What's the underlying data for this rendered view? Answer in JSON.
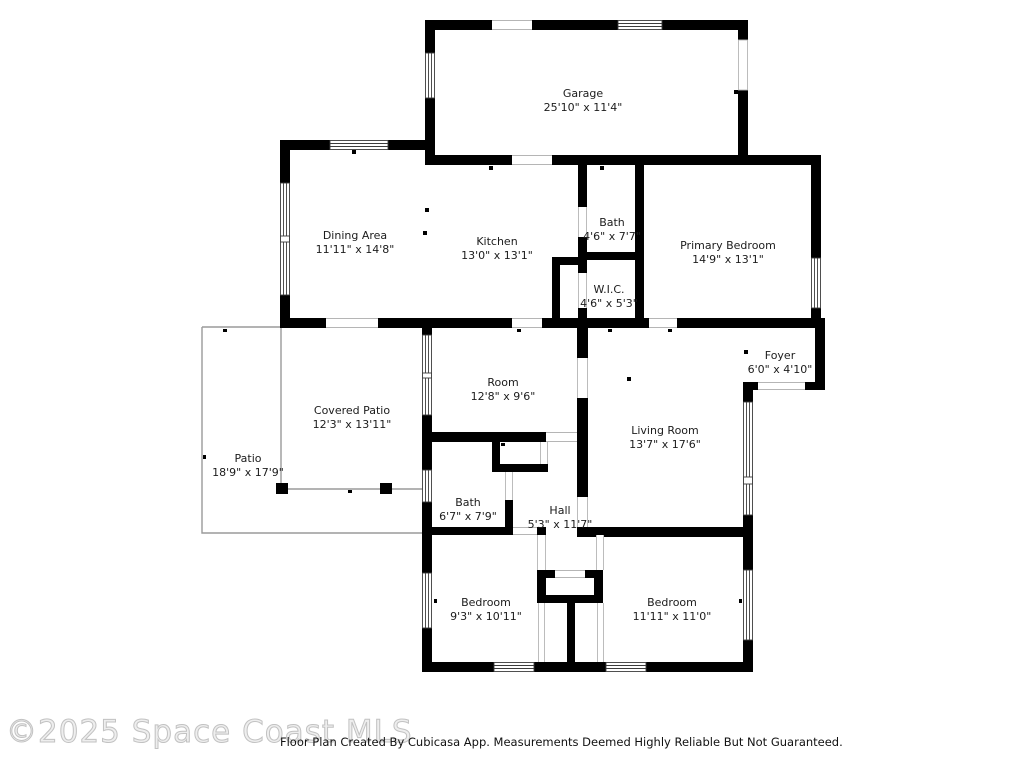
{
  "page": {
    "watermark": "©2025 Space Coast MLS",
    "footer": "Floor Plan Created By Cubicasa App. Measurements Deemed Highly Reliable But Not Guaranteed."
  },
  "floor_plan": {
    "wall_color": "#000000",
    "patio_line_color": "#9a9a9a",
    "rooms": [
      {
        "id": "garage",
        "name": "Garage",
        "dimensions": "25'10\" x 11'4\""
      },
      {
        "id": "dining-area",
        "name": "Dining Area",
        "dimensions": "11'11\" x 14'8\""
      },
      {
        "id": "kitchen",
        "name": "Kitchen",
        "dimensions": "13'0\" x 13'1\""
      },
      {
        "id": "bath-upper",
        "name": "Bath",
        "dimensions": "4'6\" x 7'7\""
      },
      {
        "id": "primary-bedroom",
        "name": "Primary Bedroom",
        "dimensions": "14'9\" x 13'1\""
      },
      {
        "id": "wic",
        "name": "W.I.C.",
        "dimensions": "4'6\" x 5'3\""
      },
      {
        "id": "foyer",
        "name": "Foyer",
        "dimensions": "6'0\" x 4'10\""
      },
      {
        "id": "room",
        "name": "Room",
        "dimensions": "12'8\" x 9'6\""
      },
      {
        "id": "covered-patio",
        "name": "Covered Patio",
        "dimensions": "12'3\" x 13'11\""
      },
      {
        "id": "patio",
        "name": "Patio",
        "dimensions": "18'9\" x 17'9\""
      },
      {
        "id": "living-room",
        "name": "Living Room",
        "dimensions": "13'7\" x 17'6\""
      },
      {
        "id": "bath-lower",
        "name": "Bath",
        "dimensions": "6'7\" x 7'9\""
      },
      {
        "id": "hall",
        "name": "Hall",
        "dimensions": "5'3\" x 11'7\""
      },
      {
        "id": "bedroom-1",
        "name": "Bedroom",
        "dimensions": "9'3\" x 10'11\""
      },
      {
        "id": "bedroom-2",
        "name": "Bedroom",
        "dimensions": "11'11\" x 11'0\""
      }
    ]
  }
}
